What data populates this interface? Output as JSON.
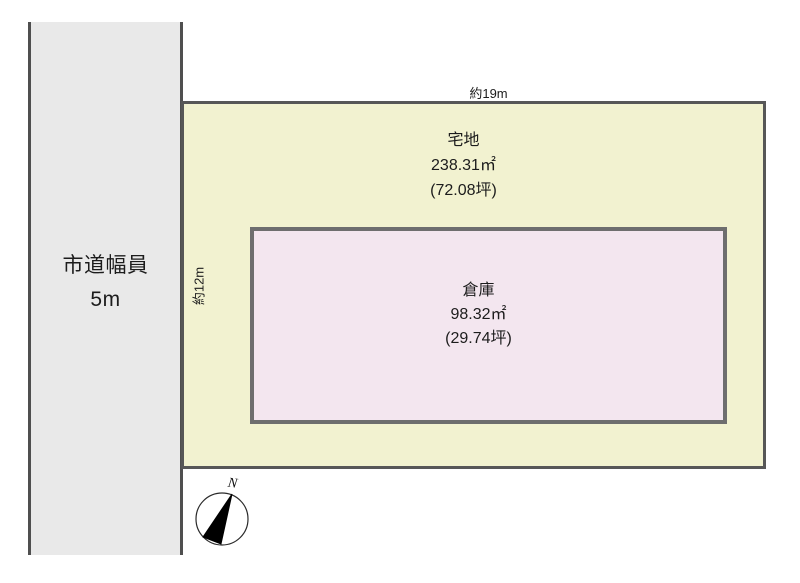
{
  "diagram": {
    "road": {
      "name": "市道幅員",
      "width": "5m"
    },
    "plot": {
      "name": "宅地",
      "area_sqm": "238.31㎡",
      "area_tsubo": "(72.08坪)"
    },
    "warehouse": {
      "name": "倉庫",
      "area_sqm": "98.32㎡",
      "area_tsubo": "(29.74坪)"
    },
    "dimensions": {
      "top_width": "約19m",
      "left_depth": "約12m"
    },
    "compass": {
      "north_label": "N"
    },
    "colors": {
      "background": "#ffffff",
      "road_fill": "#e9e9e9",
      "road_border": "#4f4f4f",
      "plot_fill": "#f2f2d0",
      "plot_border": "#575757",
      "warehouse_fill": "#f3e6ef",
      "warehouse_border": "#6e6e6e",
      "text": "#1c1c1c"
    }
  }
}
